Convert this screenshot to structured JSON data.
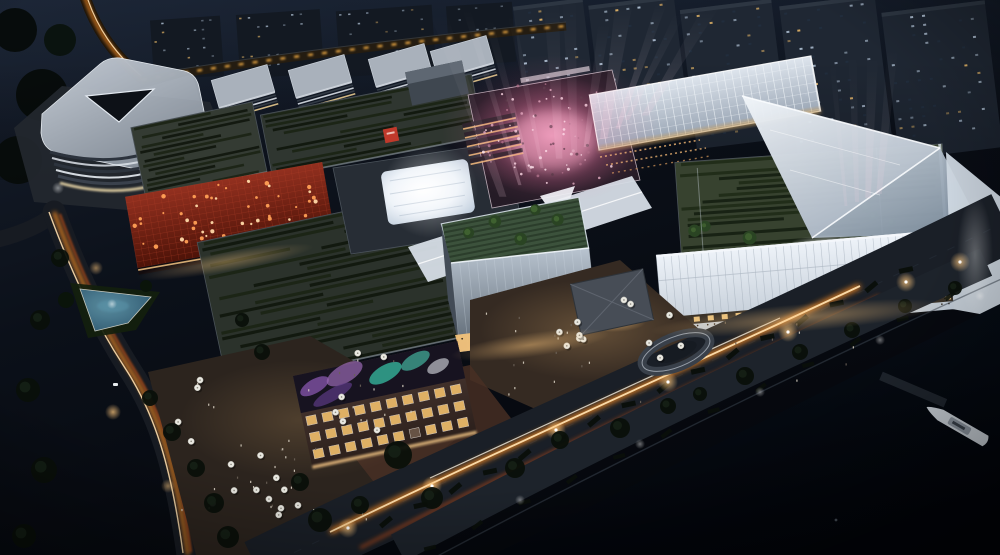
{
  "meta": {
    "width": 1000,
    "height": 555,
    "kind": "aerial-night-architectural-rendering"
  },
  "palette": {
    "base_top": "#18202e",
    "base_mid": "#0b1019",
    "base_bottom": "#04060b",
    "road": "#171b22",
    "trail_orange": "#ff8f24",
    "trail_core": "#ffdfae",
    "trail_red": "#e85a18",
    "trail_white": "#f3efe2",
    "roof_base": "#343b33",
    "roof_stripe": "#10170d",
    "roof_stripe_alt": "#1b2415",
    "roof_edge": "#8b949e",
    "slab_roof": "#a9b1bb",
    "slab_face": "#d8dee6",
    "slab_dark": "#323a44",
    "tower_fill": "#1f2733",
    "tower_low": "#131922",
    "window_cool": "#aebfd2",
    "window_warm": "#e8b868",
    "window_faint": "#223041",
    "red_base": "#8e2a1e",
    "red_grid": "#b2402a",
    "red_dot": "#ff9f55",
    "red_dot_bright": "#ffd9a8",
    "logo_red": "#c0392b",
    "pink": "#ff9ec4",
    "pink_hot": "#ffb9d2",
    "beam": "#ffd6e6",
    "glass_light": "#e2e9f2",
    "glass_mid": "#a6b2c1",
    "white_edge": "#f7fafc",
    "terrace_green": "#3c523c",
    "terrace_line": "#2b3d2b",
    "tree_green": "#2a4423",
    "tree_dark": "#0a100a",
    "hedge": "#0a0f0a",
    "facade_white": "#edf2f8",
    "mullion": "#98a4b1",
    "storefront": "#f7cd86",
    "plaza": "#2c241e",
    "plaza_warm": "#54402e",
    "brick_face": "#46342e",
    "mural_bg": "#171320",
    "mural_purple": "#7a4f9e",
    "mural_teal": "#35b39a",
    "mural_light": "#dfe3ea",
    "umbrella": "#e9e8e1",
    "umbrella_rim": "#bdbcb4",
    "people_light": "#d8d0c2",
    "people_dark": "#6a6157",
    "pool_light": "#5a93a8",
    "water": "#03050a",
    "pier": "#1e242c",
    "yacht_hull": "#ccd3da",
    "yacht_deck": "#8e97a2",
    "lamp_warm": "#ffc87e",
    "lamp_white": "#ffffff",
    "pavilion_roof": "#474d56",
    "pavilion_wall": "#e4b672"
  },
  "procedural": {
    "roof_stripe_rows": {
      "block_a": 15,
      "block_b": 13,
      "block_d": 26,
      "terrace_e": 18
    },
    "red_glow_dots": 52,
    "spotlight_beams": 11,
    "side_beams": 4,
    "crowd_dots": 95,
    "umbrellas": 33,
    "background_towers": 5,
    "office_slabs": 5
  },
  "elements": [
    "background-residential-towers",
    "elevated-road",
    "office-slabs",
    "triangle-office-building",
    "green-roof-block-a",
    "green-roof-block-b",
    "red-led-facade",
    "green-roof-block-d",
    "skylight-roof",
    "event-plaza",
    "spotlight-beams",
    "glass-grid-roof",
    "rooftop-terrace-garden",
    "faceted-glass-roof",
    "south-retail-facade",
    "canopy-walkway",
    "center-glass-pavilion",
    "mural-brick-building",
    "pedestrian-plaza",
    "umbrellas",
    "drop-off-loop",
    "pavilion",
    "boulevard-light-trails",
    "waterfront-promenade",
    "river",
    "yacht",
    "pool-garden",
    "street-trees"
  ]
}
